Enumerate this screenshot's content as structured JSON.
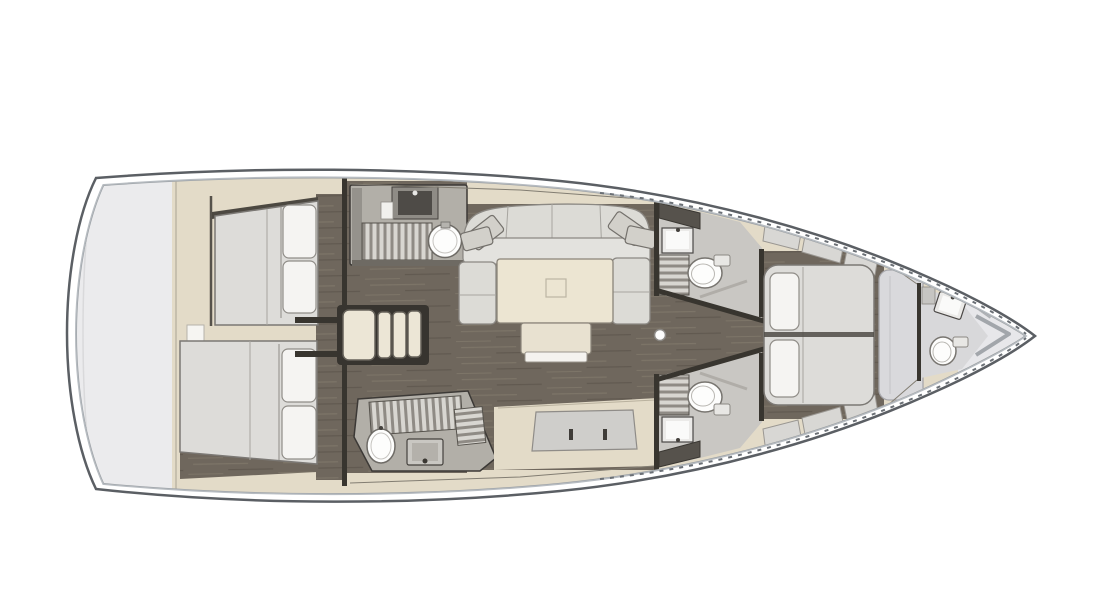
{
  "page": {
    "type": "yacht-interior-floor-plan",
    "orientation": "bow-right",
    "background": "#ffffff"
  },
  "colors": {
    "hull_line": "#5b5f64",
    "hull_rail": "#b7bcc1",
    "hull_dash": "#6a6f75",
    "deck_white": "#ffffff",
    "transom": "#ebebed",
    "cream": "#e3dbc8",
    "floor_base": "#6f675d",
    "floor_light": "#7d7568",
    "floor_dark": "#615950",
    "counter": "#b2afa8",
    "slat_light": "#d8d6d1",
    "slat_base": "#8f8b85",
    "mattress": "#dddcd9",
    "pillow": "#f5f4f2",
    "sofa": "#dcdbd6",
    "sofa_seat": "#e3e2de",
    "table": "#ece5d2",
    "bench": "#cfcecb",
    "head_floor": "#c9c7c3",
    "fixture_white": "#fdfdfc",
    "dark_wall": "#38352f",
    "dark_fixture": "#4e4b47",
    "wardrobe": "#d9d9dc",
    "locker": "#d8d7d4",
    "bow_interior": "#e7e7ea"
  },
  "vessel": {
    "rooms": [
      {
        "id": "swim-platform-stern",
        "fixtures": []
      },
      {
        "id": "aft-cabin-port",
        "fixtures": [
          "double-bed",
          "pillow",
          "pillow",
          "wardrobe-band"
        ]
      },
      {
        "id": "aft-cabin-starboard",
        "fixtures": [
          "double-bed",
          "pillow",
          "pillow"
        ]
      },
      {
        "id": "companionway-stairs",
        "fixtures": [
          "step",
          "step",
          "step",
          "step"
        ]
      },
      {
        "id": "galley-port",
        "fixtures": [
          "sink-square",
          "cutting-board",
          "galley-grate",
          "round-basin"
        ]
      },
      {
        "id": "saloon",
        "fixtures": [
          "u-sofa",
          "corner-cushions",
          "dining-table",
          "bench-seat"
        ]
      },
      {
        "id": "galley-starboard",
        "fixtures": [
          "galley-grate",
          "rack-grate",
          "oval-sink",
          "stove"
        ]
      },
      {
        "id": "head-port",
        "fixtures": [
          "washbasin",
          "shower-grate",
          "toilet"
        ]
      },
      {
        "id": "head-starboard",
        "fixtures": [
          "washbasin",
          "shower-grate",
          "toilet"
        ]
      },
      {
        "id": "corridor",
        "fixtures": [
          "mast-post"
        ]
      },
      {
        "id": "forward-cabin",
        "fixtures": [
          "island-bed",
          "pillow",
          "pillow",
          "lockers",
          "wardrobe"
        ]
      },
      {
        "id": "forward-head",
        "fixtures": [
          "washbasin",
          "toilet",
          "shelf"
        ]
      },
      {
        "id": "bow-locker",
        "fixtures": [
          "anchor-locker-bulkhead"
        ]
      }
    ],
    "counts": {
      "cabins": 3,
      "toilets": 3,
      "bathroom_sinks": 3,
      "galley_sinks": 2,
      "beds": 3
    }
  }
}
